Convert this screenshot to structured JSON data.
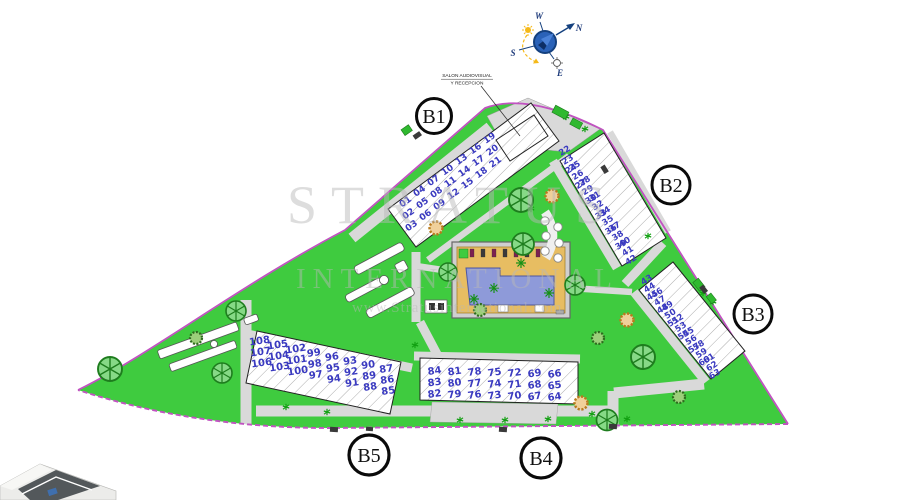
{
  "plan": {
    "callout": {
      "line1": "SALON AUDIOVISUAL",
      "line2": "Y RECEPCION"
    },
    "compass": {
      "n": "N",
      "s": "S",
      "e": "E",
      "w": "W"
    },
    "watermark": {
      "title": "STRATUS",
      "subtitle": "INTERNATIONAL",
      "url": "www.Stratusinternational.com"
    },
    "blocks": [
      {
        "id": "b1",
        "label": "B1",
        "units": [
          [
            "01",
            "02",
            "03"
          ],
          [
            "04",
            "05",
            "06"
          ],
          [
            "07",
            "08",
            "09"
          ],
          [
            "10",
            "11",
            "12"
          ],
          [
            "13",
            "14",
            "15"
          ],
          [
            "16",
            "17",
            "18"
          ],
          [
            "19",
            "20",
            "21"
          ]
        ]
      },
      {
        "id": "b2",
        "label": "B2",
        "units": [
          [
            "22",
            "23",
            "24"
          ],
          [
            "25",
            "26",
            "27"
          ],
          [
            "28",
            "29",
            "30"
          ],
          [
            "31",
            "32",
            "33"
          ],
          [
            "34",
            "35",
            "36"
          ],
          [
            "37",
            "38",
            "39"
          ],
          [
            "40",
            "41",
            "42"
          ]
        ]
      },
      {
        "id": "b3",
        "label": "B3",
        "units": [
          [
            "43",
            "44",
            "45"
          ],
          [
            "46",
            "47",
            "48"
          ],
          [
            "49",
            "50",
            "51"
          ],
          [
            "52",
            "53",
            "54"
          ],
          [
            "55",
            "56",
            "57"
          ],
          [
            "58",
            "59",
            "60"
          ],
          [
            "61",
            "62",
            "63"
          ]
        ]
      },
      {
        "id": "b4",
        "label": "B4",
        "units": [
          [
            "84",
            "83",
            "82"
          ],
          [
            "81",
            "80",
            "79"
          ],
          [
            "78",
            "77",
            "76"
          ],
          [
            "75",
            "74",
            "73"
          ],
          [
            "72",
            "71",
            "70"
          ],
          [
            "69",
            "68",
            "67"
          ],
          [
            "66",
            "65",
            "64"
          ]
        ]
      },
      {
        "id": "b5",
        "label": "B5",
        "units": [
          [
            "108",
            "107",
            "106"
          ],
          [
            "105",
            "104",
            "103"
          ],
          [
            "102",
            "101",
            "100"
          ],
          [
            "99",
            "98",
            "97"
          ],
          [
            "96",
            "95",
            "94"
          ],
          [
            "93",
            "92",
            "91"
          ],
          [
            "90",
            "89",
            "88"
          ],
          [
            "87",
            "86",
            "85"
          ]
        ]
      }
    ],
    "palette": {
      "grass": "#3fcb3f",
      "road": "#d9d9d9",
      "pool_deck": "#e7bd62",
      "pool_water": "#8e9ad9",
      "boundary": "#c153c1",
      "unit_numbers": "#3a3ac0",
      "compass_blue": "#2a62b8",
      "sun_yellow": "#f5b919"
    },
    "icons": {
      "tree": "wheel-tree-icon",
      "bush": "shrub-icon",
      "sprig": "plant-sprig-icon",
      "compass": "compass-rose-icon",
      "sun": "sun-icon"
    }
  }
}
